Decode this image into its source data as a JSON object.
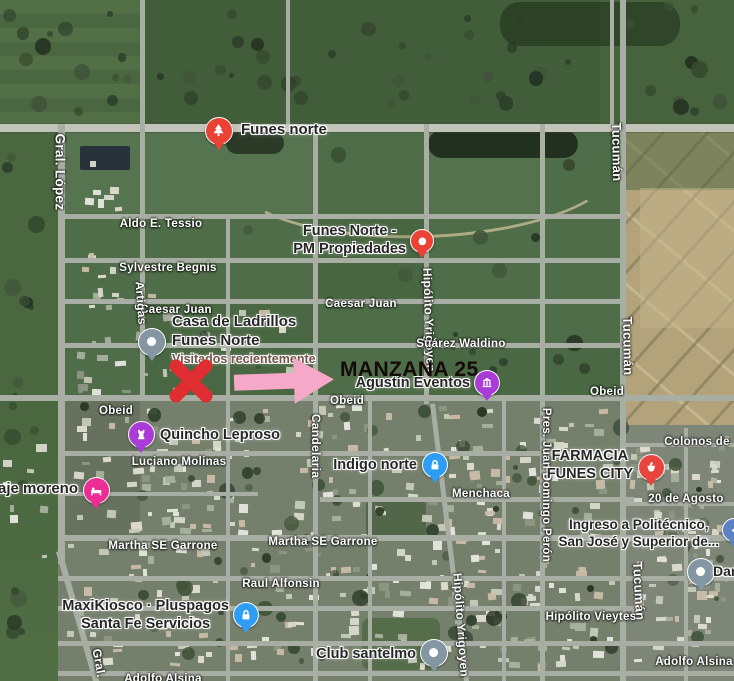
{
  "annotation": {
    "label": "MANZANA 25"
  },
  "colors": {
    "x_mark": "#E02D32",
    "arrow": "#F5A8C7",
    "manzana": "#140B08",
    "street_text": "#FFFFFF",
    "poi_text": "#262626",
    "visited_text": "#75524A"
  },
  "streets": [
    {
      "label": "Gral. López",
      "x": 60,
      "y": 172,
      "r": 90,
      "fs": 13.5
    },
    {
      "label": "Aldo E. Tessio",
      "x": 161,
      "y": 224,
      "r": 0,
      "fs": 11.5
    },
    {
      "label": "Sylvestre Begnis",
      "x": 168,
      "y": 268,
      "r": 0,
      "fs": 11.5
    },
    {
      "label": "Caesar Juan",
      "x": 176,
      "y": 310,
      "r": 0,
      "fs": 11.5
    },
    {
      "label": "Caesar Juan",
      "x": 361,
      "y": 304,
      "r": 0,
      "fs": 11.5
    },
    {
      "label": "Artigas",
      "x": 141,
      "y": 303,
      "r": 86,
      "fs": 12
    },
    {
      "label": "Hipólito Yrigoyen",
      "x": 429,
      "y": 320,
      "r": 88,
      "fs": 12
    },
    {
      "label": "Suárez Waldino",
      "x": 461,
      "y": 344,
      "r": 0,
      "fs": 11.5
    },
    {
      "label": "Obeid",
      "x": 116,
      "y": 411,
      "r": 0,
      "fs": 11.5
    },
    {
      "label": "Obeid",
      "x": 347,
      "y": 401,
      "r": 0,
      "fs": 11.5
    },
    {
      "label": "Obeid",
      "x": 607,
      "y": 392,
      "r": 0,
      "fs": 11.5
    },
    {
      "label": "Tucumán",
      "x": 617,
      "y": 152,
      "r": 89,
      "fs": 13
    },
    {
      "label": "Tucumán",
      "x": 628,
      "y": 346,
      "r": 89,
      "fs": 13
    },
    {
      "label": "Tucumán",
      "x": 639,
      "y": 591,
      "r": 87,
      "fs": 13
    },
    {
      "label": "Candelaria",
      "x": 316,
      "y": 446,
      "r": 90,
      "fs": 12
    },
    {
      "label": "Pres. Juan Domingo Perón",
      "x": 546,
      "y": 485,
      "r": 90,
      "fs": 11.5
    },
    {
      "label": "Luciano Molinas",
      "x": 179,
      "y": 462,
      "r": 0,
      "fs": 11.5
    },
    {
      "label": "Menchaca",
      "x": 481,
      "y": 494,
      "r": 0,
      "fs": 11.5
    },
    {
      "label": "Colonos de",
      "x": 697,
      "y": 442,
      "r": 0,
      "fs": 11.5
    },
    {
      "label": "20 de Agosto",
      "x": 686,
      "y": 499,
      "r": 0,
      "fs": 11.5
    },
    {
      "label": "Martha SE Garrone",
      "x": 163,
      "y": 546,
      "r": 0,
      "fs": 11.5
    },
    {
      "label": "Martha SE Garrone",
      "x": 323,
      "y": 542,
      "r": 0,
      "fs": 11.5
    },
    {
      "label": "Raul Alfonsin",
      "x": 281,
      "y": 584,
      "r": 0,
      "fs": 11.5
    },
    {
      "label": "Hipólito Vieytes",
      "x": 591,
      "y": 617,
      "r": 0,
      "fs": 11.5
    },
    {
      "label": "Adolfo Alsina",
      "x": 694,
      "y": 662,
      "r": 0,
      "fs": 11.5
    },
    {
      "label": "Adolfo Alsina",
      "x": 163,
      "y": 679,
      "r": 0,
      "fs": 11.5
    },
    {
      "label": "Hipólito Yrigoyen",
      "x": 461,
      "y": 625,
      "r": 86,
      "fs": 12
    },
    {
      "label": "Gral.",
      "x": 99,
      "y": 663,
      "r": 80,
      "fs": 12
    }
  ],
  "pois": [
    {
      "name": "funes-norte-park",
      "icon": "tree-icon",
      "color": "#EA4335",
      "d": 26,
      "x": 218,
      "y": 130,
      "label": {
        "lines": [
          "Funes norte"
        ],
        "x": 241,
        "y": 121,
        "align": "left",
        "fs": 15
      }
    },
    {
      "name": "funes-norte-pm-propiedades",
      "icon": "dot-icon",
      "color": "#EA4335",
      "d": 22,
      "x": 421,
      "y": 240,
      "label": {
        "lines": [
          "Funes Norte -",
          "PM Propiedades"
        ],
        "x": 406,
        "y": 222,
        "align": "right",
        "fs": 14.5
      }
    },
    {
      "name": "casa-de-ladrillos",
      "icon": "dot-icon",
      "color": "#8596A3",
      "d": 26,
      "x": 151,
      "y": 341,
      "label": {
        "lines": [
          "Casa de Ladrillos",
          "Funes Norte"
        ],
        "x": 172,
        "y": 313,
        "align": "left",
        "fs": 15
      },
      "sub": "Visitados recientemente"
    },
    {
      "name": "agustin-eventos",
      "icon": "event-icon",
      "color": "#A93BD6",
      "d": 24,
      "x": 486,
      "y": 382,
      "label": {
        "lines": [
          "Agustín Eventos"
        ],
        "x": 470,
        "y": 374,
        "align": "right",
        "fs": 14.5
      }
    },
    {
      "name": "quincho-leproso",
      "icon": "rook-icon",
      "color": "#A93BD6",
      "d": 25,
      "x": 140,
      "y": 433,
      "label": {
        "lines": [
          "Quincho Leproso"
        ],
        "x": 160,
        "y": 426,
        "align": "left",
        "fs": 14.5
      }
    },
    {
      "name": "hospedaje-moreno",
      "icon": "bed-icon",
      "color": "#EC2D95",
      "d": 25,
      "x": 95,
      "y": 489,
      "label": {
        "lines": [
          "daje moreno"
        ],
        "x": 78,
        "y": 480,
        "align": "right",
        "fs": 15
      }
    },
    {
      "name": "indigo-norte",
      "icon": "padlock-icon",
      "color": "#2E9DF6",
      "d": 24,
      "x": 434,
      "y": 464,
      "label": {
        "lines": [
          "Indigo norte"
        ],
        "x": 417,
        "y": 456,
        "align": "right",
        "fs": 14.5
      }
    },
    {
      "name": "farmacia-funes-city",
      "icon": "pharmacy-icon",
      "color": "#E8453C",
      "d": 25,
      "x": 650,
      "y": 466,
      "label": {
        "lines": [
          "FARMACIA",
          "FUNES CITY"
        ],
        "x": 633,
        "y": 447,
        "align": "right",
        "fs": 14.5
      }
    },
    {
      "name": "ingreso-politecnico",
      "icon": "arrow-icon",
      "color": "#5B82C4",
      "d": 22,
      "x": 733,
      "y": 529,
      "label": {
        "lines": [
          "Ingreso a Politécnico,",
          "San José y Superior de..."
        ],
        "x": 719,
        "y": 517,
        "align": "right",
        "fs": 13.5
      }
    },
    {
      "name": "danza",
      "icon": "dot-icon",
      "color": "#8596A3",
      "d": 26,
      "x": 700,
      "y": 571,
      "label": {
        "lines": [
          "Danza..."
        ],
        "x": 713,
        "y": 563,
        "align": "left",
        "fs": 14
      }
    },
    {
      "name": "maxikiosco-pluspagos",
      "icon": "padlock-icon",
      "color": "#2E9DF6",
      "d": 24,
      "x": 245,
      "y": 614,
      "label": {
        "lines": [
          "MaxiKiosco · Pluspagos",
          "Santa Fe Servicios"
        ],
        "x": 229,
        "y": 597,
        "align": "right",
        "fs": 14.5
      }
    },
    {
      "name": "club-santelmo",
      "icon": "dot-icon",
      "color": "#8596A3",
      "d": 26,
      "x": 433,
      "y": 652,
      "label": {
        "lines": [
          "Club santelmo"
        ],
        "x": 416,
        "y": 645,
        "align": "right",
        "fs": 14.5
      }
    }
  ]
}
